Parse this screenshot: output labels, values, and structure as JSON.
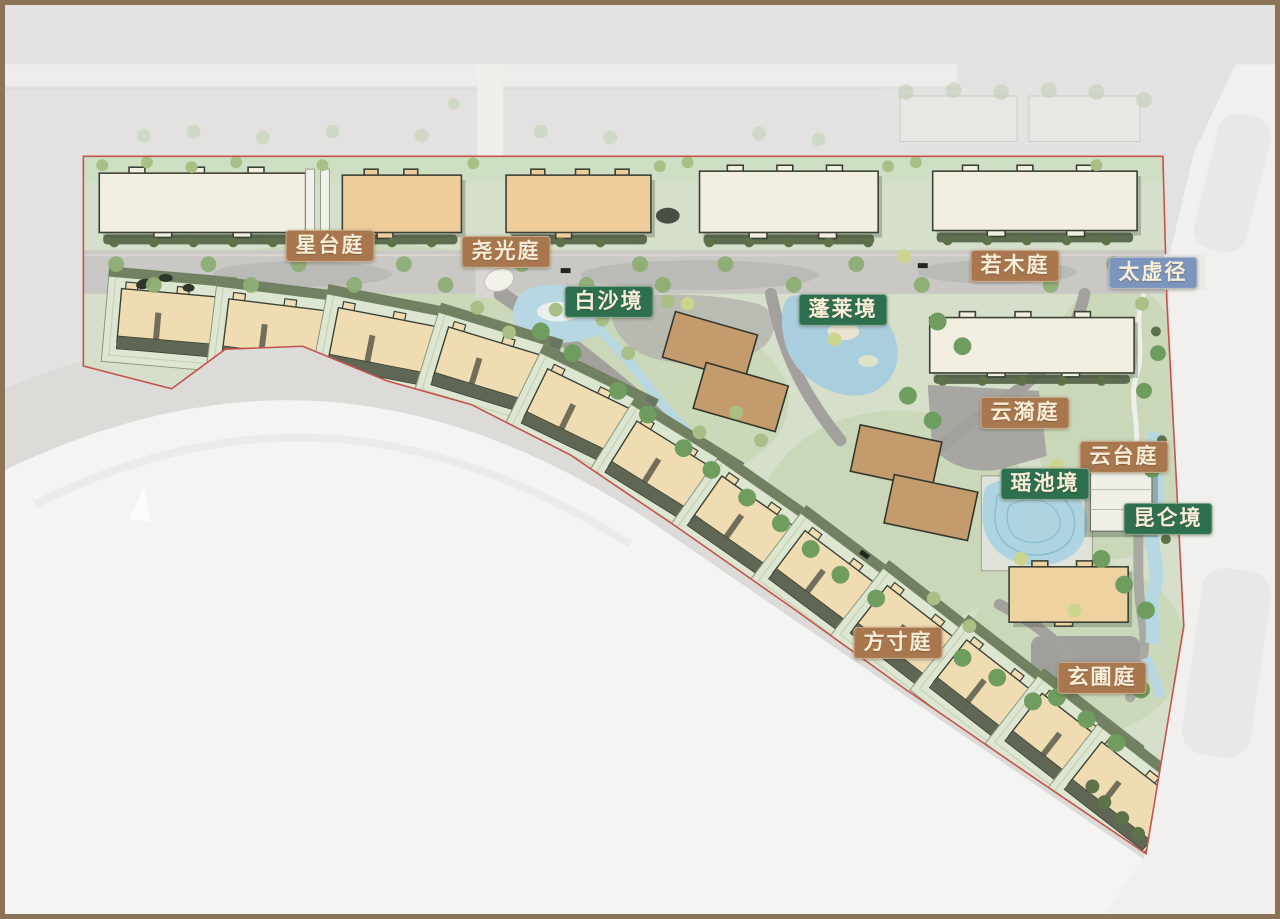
{
  "plan": {
    "labels": [
      {
        "id": "xingtai",
        "text": "星台庭",
        "category": "court"
      },
      {
        "id": "yaoguang",
        "text": "尧光庭",
        "category": "court"
      },
      {
        "id": "baisha",
        "text": "白沙境",
        "category": "realm"
      },
      {
        "id": "penglai",
        "text": "蓬莱境",
        "category": "realm"
      },
      {
        "id": "ruomu",
        "text": "若木庭",
        "category": "court"
      },
      {
        "id": "taixu",
        "text": "太虚径",
        "category": "path"
      },
      {
        "id": "yunyi",
        "text": "云漪庭",
        "category": "court"
      },
      {
        "id": "yuntai",
        "text": "云台庭",
        "category": "court"
      },
      {
        "id": "yaochi",
        "text": "瑶池境",
        "category": "realm"
      },
      {
        "id": "kunlun",
        "text": "昆仑境",
        "category": "realm"
      },
      {
        "id": "fangcun",
        "text": "方寸庭",
        "category": "court"
      },
      {
        "id": "xuanpu",
        "text": "玄圃庭",
        "category": "court"
      }
    ],
    "category_colors": {
      "court_bg": "#a9774e",
      "realm_bg": "#2e6f50",
      "path_bg": "#7b95bd",
      "label_text": "#f7eed9"
    },
    "palette": {
      "frame": "#8a7356",
      "canvas": "#e3e2e0",
      "landscape": "#d6dfc9",
      "boundary_line": "#c4534d",
      "water": "#aed4e2",
      "road": "#c9c8c5",
      "building_cream": "#f2efe0",
      "building_tan": "#eecd9b",
      "building_brown": "#c49b6d",
      "townhouse": "#f0dcb2"
    }
  }
}
